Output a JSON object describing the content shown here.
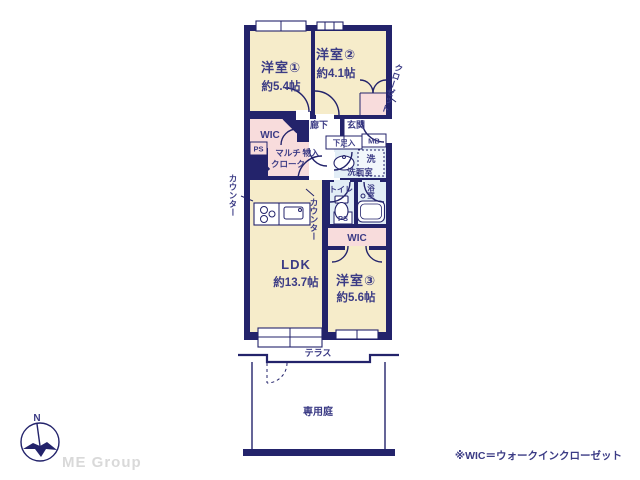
{
  "plan": {
    "rooms": {
      "yoshitsu1": {
        "name": "洋室①",
        "size": "約5.4帖"
      },
      "yoshitsu2": {
        "name": "洋室②",
        "size": "約4.1帖"
      },
      "yoshitsu3": {
        "name": "洋室③",
        "size": "約5.6帖"
      },
      "ldk": {
        "name": "LDK",
        "size": "約13.7帖"
      }
    },
    "labels": {
      "wic_upper": "WIC",
      "wic_lower": "WIC",
      "ps_upper": "PS",
      "ps_lower": "PS",
      "multicloak1": "マルチ",
      "multicloak2": "クローク",
      "monoire": "物入",
      "rouka": "廊下",
      "genkan": "玄関",
      "getabako": "下足入",
      "mb": "MB",
      "laundry": "洗",
      "senmenshitsu": "洗面室",
      "toilet": "トイレ",
      "bath": "浴室",
      "closet": "クローゼット",
      "counter_left": "カウンター",
      "counter_mid": "カウンター",
      "terrace": "テラス",
      "garden": "専用庭"
    }
  },
  "compass": {
    "north": "N"
  },
  "footer": {
    "brand": "ME Group",
    "note": "※WIC＝ウォークインクローゼット"
  },
  "colors": {
    "wall": "#23236b",
    "cream": "#f6ecca",
    "pink": "#f8dcdc",
    "blue": "#e2edf6",
    "text": "#3b3b85",
    "brand": "#d9d9d9"
  }
}
